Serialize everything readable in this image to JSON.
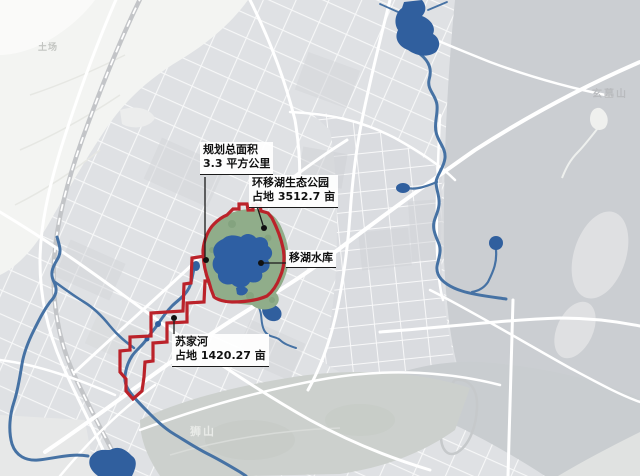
{
  "map": {
    "annotations": {
      "planning_area": {
        "line1": "规划总面积",
        "line2": "3.3 平方公里"
      },
      "eco_park": {
        "line1": "环移湖生态公园",
        "line2": "占地 3512.7 亩"
      },
      "reservoir": {
        "label": "移湖水库"
      },
      "sujia_river": {
        "line1": "苏家河",
        "line2": "占地 1420.27 亩"
      }
    },
    "place_labels": {
      "tuchang": "土场",
      "xuanmushan": "玄墓山",
      "shishan": "狮山"
    },
    "colors": {
      "boundary_red": "#bb222a",
      "lake_blue": "#305f9e",
      "river_blue": "#4672a4",
      "park_green": "#90ad8a",
      "city_block_gray": "#dfe1e4",
      "mountain_gray": "#cbced2"
    }
  }
}
